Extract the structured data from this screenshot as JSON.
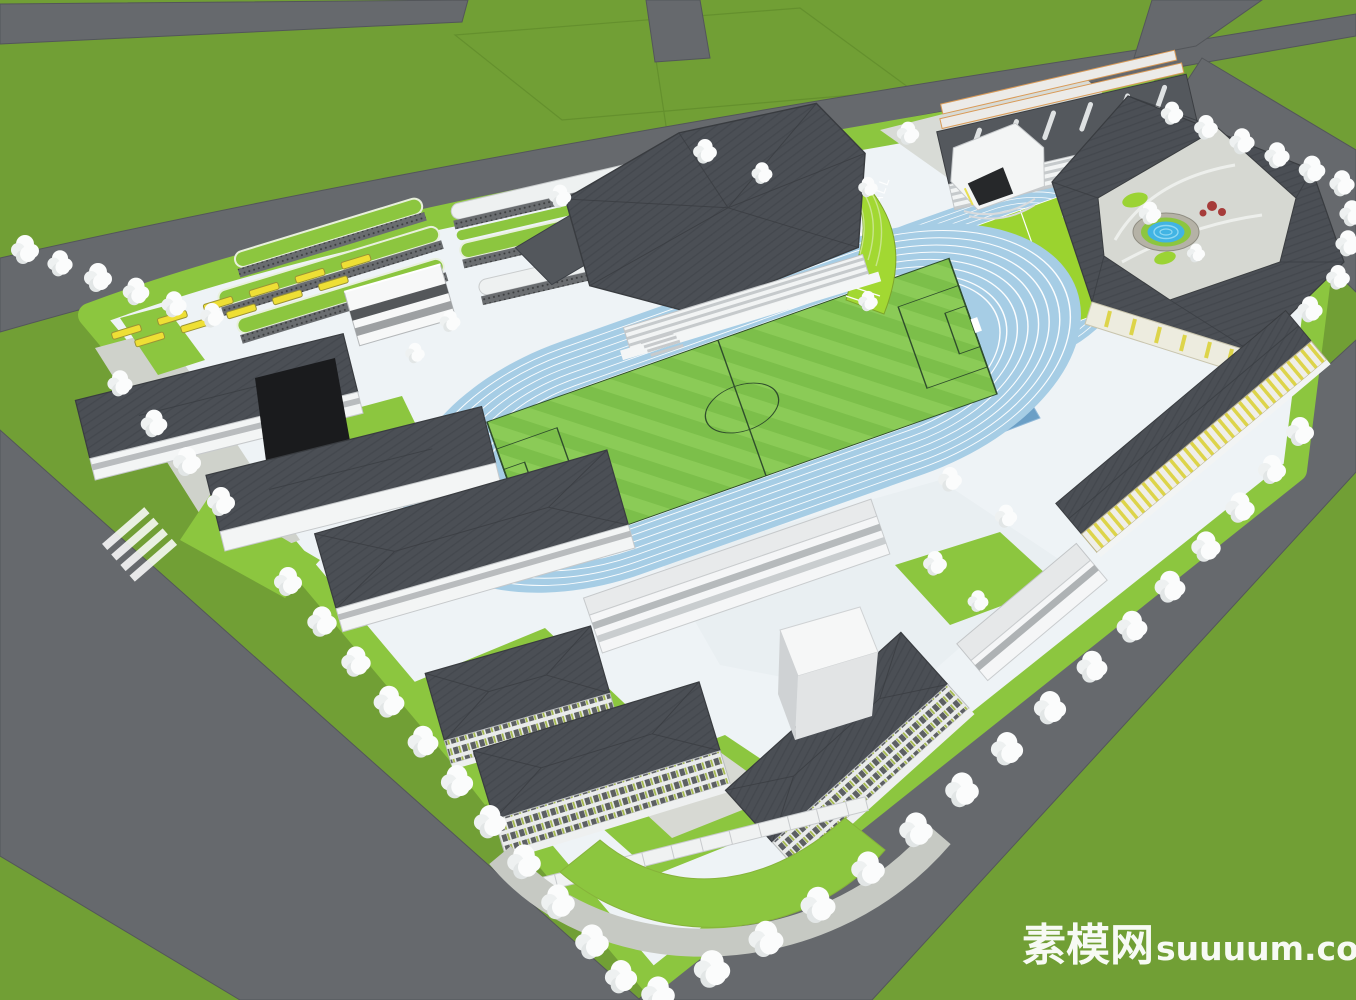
{
  "watermark": {
    "site_name": "素模网",
    "domain": "suuuum.com"
  },
  "sports": {
    "basketball_label": "BASKETBALL"
  },
  "palette": {
    "grass_outer": "#719f35",
    "road_gray": "#66696d",
    "campus_plaza": "#eef3f6",
    "lawn_green": "#8cc63f",
    "bright_green": "#a2d832",
    "track_blue": "#a6cde5",
    "court_blue": "#6b9fc6",
    "court_blue_dark": "#4f81aa",
    "mini_pitch_green": "#9bd32f",
    "pitch_stripe_a": "#7cbf4a",
    "pitch_stripe_b": "#8bcb57",
    "pool_blue": "#41b4e4",
    "roof_dark_gray": "#4b4f55",
    "wall_white": "#f5f6f7",
    "bus_yellow": "#eedf35",
    "tree_white": "#fbfcfc",
    "accent_orange": "#d99a57"
  },
  "scene": {
    "type": "aerial-3d-architectural-render",
    "subject": "school campus master plan model"
  }
}
